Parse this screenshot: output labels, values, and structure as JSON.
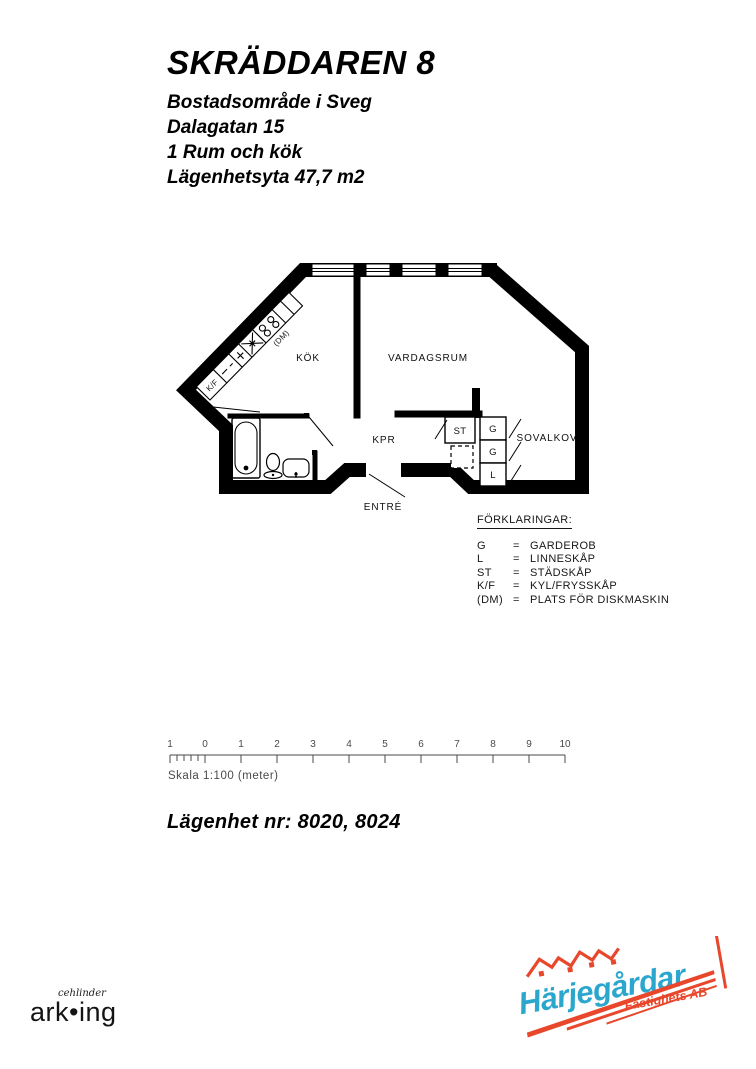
{
  "header": {
    "title": "SKRÄDDAREN 8",
    "lines": [
      "Bostadsområde i Sveg",
      "Dalagatan 15",
      "1 Rum och kök",
      "Lägenhetsyta 47,7 m2"
    ]
  },
  "floorplan": {
    "room_labels": [
      "KÖK",
      "VARDAGSRUM",
      "KPR",
      "SOVALKOV",
      "ENTRÉ"
    ],
    "closet_labels": [
      "ST",
      "G",
      "G",
      "L"
    ],
    "counter_labels": {
      "kf": "K/F",
      "dm": "(DM)"
    }
  },
  "legend": {
    "title": "FÖRKLARINGAR:",
    "separator": "=",
    "items": [
      {
        "abbr": "G",
        "label": "GARDEROB"
      },
      {
        "abbr": "L",
        "label": "LINNESKÅP"
      },
      {
        "abbr": "ST",
        "label": "STÄDSKÅP"
      },
      {
        "abbr": "K/F",
        "label": "KYL/FRYSSKÅP"
      },
      {
        "abbr": "(DM)",
        "label": "PLATS FÖR DISKMASKIN"
      }
    ]
  },
  "scalebar": {
    "caption": "Skala 1:100 (meter)",
    "tick_labels": [
      "1",
      "0",
      "1",
      "2",
      "3",
      "4",
      "5",
      "6",
      "7",
      "8",
      "9",
      "10"
    ]
  },
  "apartment_numbers": "Lägenhet nr: 8020, 8024",
  "logos": {
    "arking": {
      "script": "cehlinder",
      "name": "ark•ing"
    },
    "harjegardar": {
      "name": "Härjegårdar",
      "sub": "Fastighets AB",
      "blue": "#2ba7ce",
      "red": "#e8472b"
    }
  }
}
